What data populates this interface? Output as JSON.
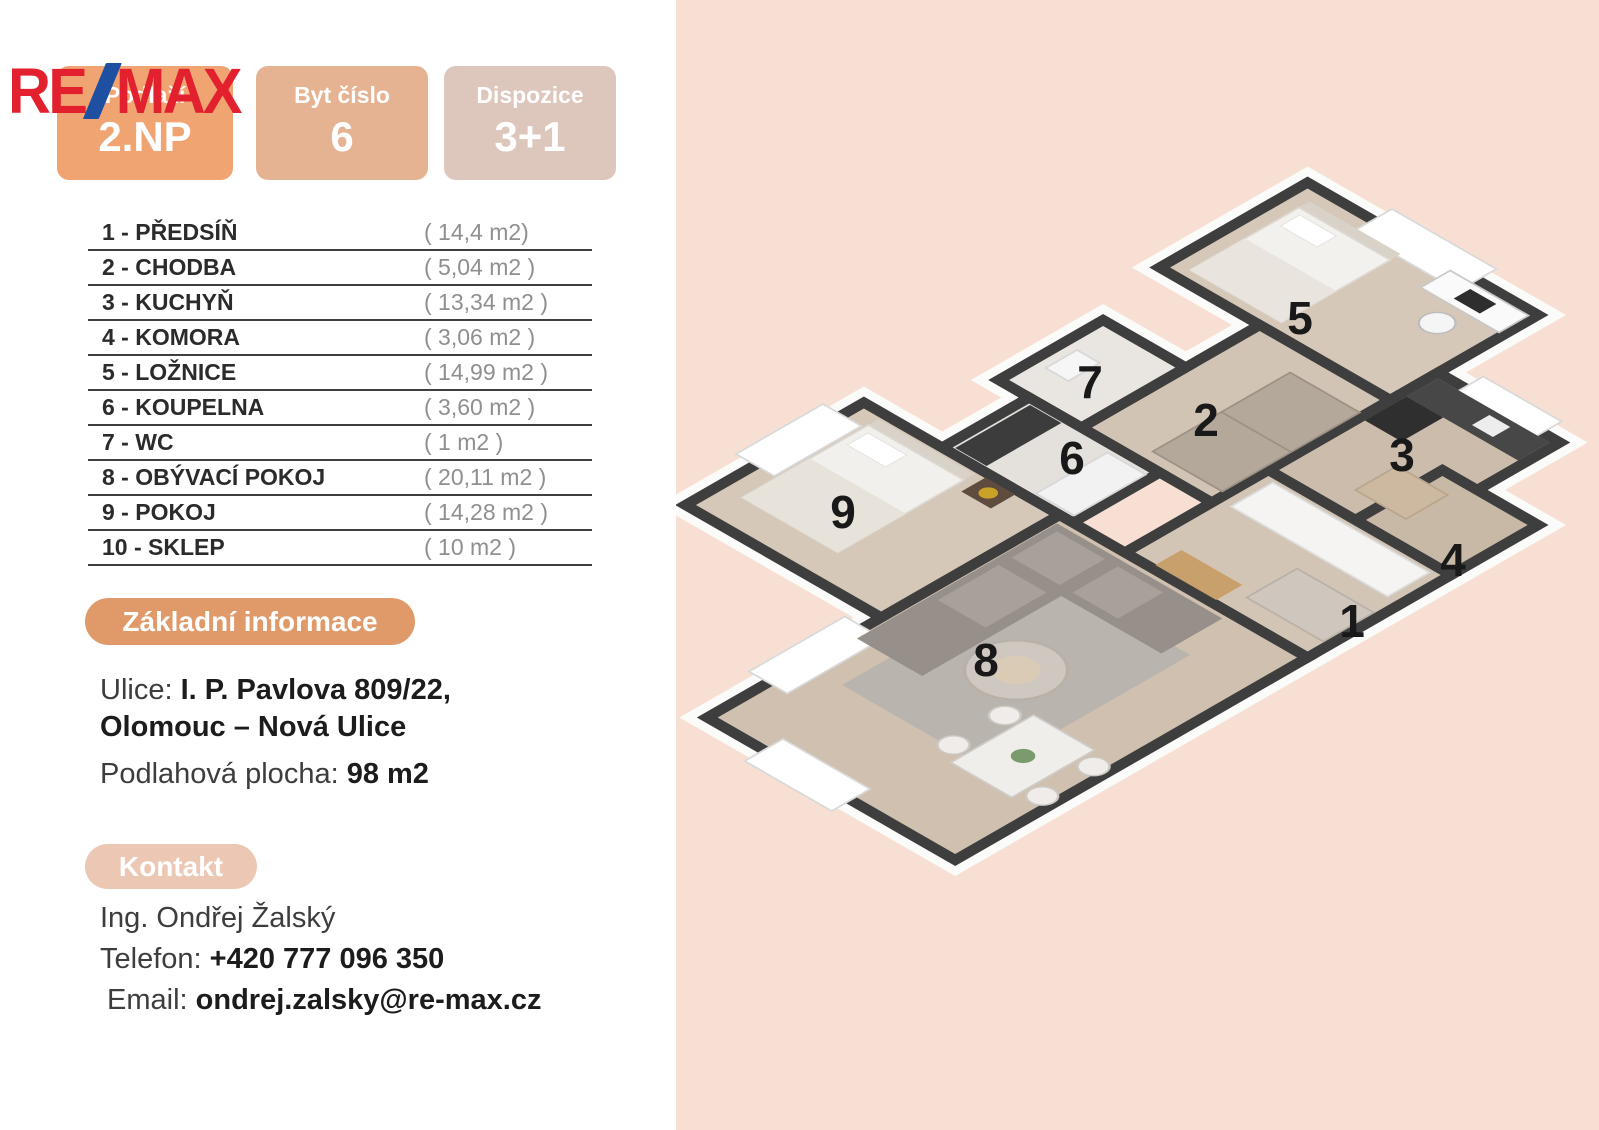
{
  "logo": {
    "re": "RE",
    "slash_icon": "/",
    "max": "MAX"
  },
  "badges": [
    {
      "label": "Podlaží",
      "value": "2.NP"
    },
    {
      "label": "Byt číslo",
      "value": "6"
    },
    {
      "label": "Dispozice",
      "value": "3+1"
    }
  ],
  "rooms": [
    {
      "label": "1 - PŘEDSÍŇ",
      "area": "( 14,4 m2)"
    },
    {
      "label": "2 - CHODBA",
      "area": "( 5,04 m2 )"
    },
    {
      "label": "3 - KUCHYŇ",
      "area": "( 13,34 m2 )"
    },
    {
      "label": "4 - KOMORA",
      "area": "( 3,06 m2 )"
    },
    {
      "label": "5 - LOŽNICE",
      "area": "( 14,99 m2 )"
    },
    {
      "label": "6 - KOUPELNA",
      "area": "( 3,60 m2 )"
    },
    {
      "label": "7 - WC",
      "area": "( 1 m2 )"
    },
    {
      "label": "8 - OBÝVACÍ POKOJ",
      "area": "( 20,11 m2 )"
    },
    {
      "label": "9 - POKOJ",
      "area": "( 14,28 m2 )"
    },
    {
      "label": "10 - SKLEP",
      "area": "( 10 m2 )"
    }
  ],
  "info": {
    "title": "Základní informace",
    "street_label": "Ulice:",
    "street_line1": "I. P. Pavlova 809/22,",
    "street_line2": "Olomouc – Nová Ulice",
    "area_label": "Podlahová plocha:",
    "area_value": "98 m2"
  },
  "contact": {
    "title": "Kontakt",
    "name": "Ing. Ondřej Žalský",
    "phone_label": "Telefon:",
    "phone": "+420 777 096 350",
    "email_label": "Email:",
    "email": "ondrej.zalsky@re-max.cz"
  },
  "plan": {
    "labels": [
      {
        "n": "5"
      },
      {
        "n": "7"
      },
      {
        "n": "2"
      },
      {
        "n": "3"
      },
      {
        "n": "6"
      },
      {
        "n": "9"
      },
      {
        "n": "4"
      },
      {
        "n": "1"
      },
      {
        "n": "8"
      }
    ]
  },
  "colors": {
    "brand_red": "#e2202e",
    "brand_blue": "#1f4fa0",
    "panel_peach": "#f7e0d3",
    "badge_floor": "#efa472",
    "badge_unit": "#e6b392",
    "badge_layout": "#ddc6bb",
    "info_pill": "#e09a6a",
    "contact_pill": "#ecc8b4",
    "wall_dark": "#3e3e3e",
    "floor_wood": "#d6c8b8"
  }
}
